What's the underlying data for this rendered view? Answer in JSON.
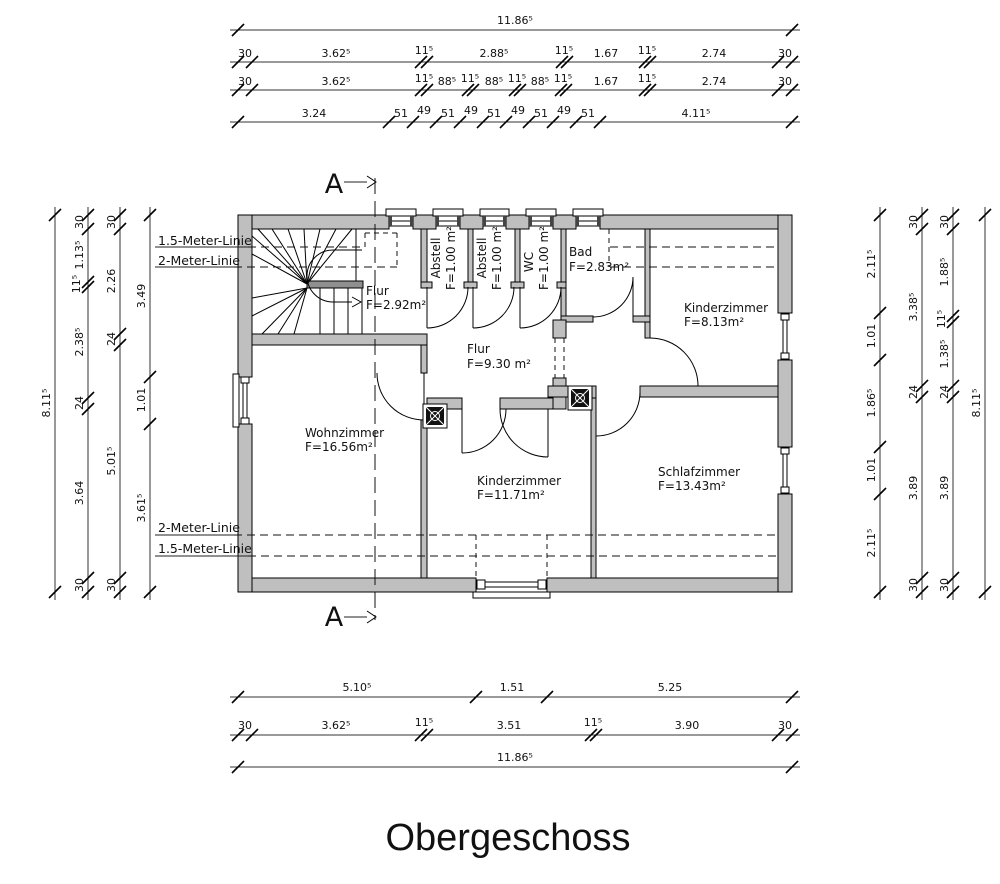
{
  "title": "Obergeschoss",
  "section": {
    "letter": "A"
  },
  "rooms": {
    "stair_flur": {
      "name": "Flur",
      "area": "F=2.92m²"
    },
    "abstell1": {
      "name": "Abstell",
      "area": "F=1.00 m²"
    },
    "abstell2": {
      "name": "Abstell",
      "area": "F=1.00 m²"
    },
    "wc": {
      "name": "WC",
      "area": "F=1.00 m²"
    },
    "bad": {
      "name": "Bad",
      "area": "F=2.83m²"
    },
    "kinderzimmer_top": {
      "name": "Kinderzimmer",
      "area": "F=8.13m²"
    },
    "flur": {
      "name": "Flur",
      "area": "F=9.30 m²"
    },
    "wohnzimmer": {
      "name": "Wohnzimmer",
      "area": "F=16.56m²"
    },
    "kinderzimmer_bottom": {
      "name": "Kinderzimmer",
      "area": "F=11.71m²"
    },
    "schlafzimmer": {
      "name": "Schlafzimmer",
      "area": "F=13.43m²"
    }
  },
  "guide_labels": {
    "top_15": "1.5-Meter-Linie",
    "top_20": "2-Meter-Linie",
    "bottom_20": "2-Meter-Linie",
    "bottom_15": "1.5-Meter-Linie"
  },
  "dims": {
    "top": {
      "total": "11.86⁵",
      "row2": [
        "30",
        "3.62⁵",
        "11⁵",
        "2.88⁵",
        "11⁵",
        "1.67",
        "11⁵",
        "2.74",
        "30"
      ],
      "row3": [
        "30",
        "3.62⁵",
        "11⁵",
        "88⁵",
        "11⁵",
        "88⁵",
        "11⁵",
        "88⁵",
        "11⁵",
        "1.67",
        "11⁵",
        "2.74",
        "30"
      ],
      "row4": [
        "3.24",
        "51",
        "49",
        "51",
        "49",
        "51",
        "49",
        "51",
        "49",
        "51",
        "4.11⁵"
      ]
    },
    "bottom": {
      "row1": [
        "5.10⁵",
        "1.51",
        "5.25"
      ],
      "row2": [
        "30",
        "3.62⁵",
        "11⁵",
        "3.51",
        "11⁵",
        "3.90",
        "30"
      ],
      "total": "11.86⁵"
    },
    "left": {
      "total": "8.11⁵",
      "col2": [
        "30",
        "1.13⁵",
        "11⁵",
        "2.38⁵",
        "24",
        "3.64",
        "30"
      ],
      "col3": [
        "30",
        "2.26",
        "24",
        "5.01⁵",
        "30"
      ],
      "col4": [
        "3.49",
        "1.01",
        "3.61⁵"
      ]
    },
    "right": {
      "col1": [
        "2.11⁵",
        "1.01",
        "1.86⁵",
        "1.01",
        "2.11⁵"
      ],
      "col2": [
        "30",
        "3.38⁵",
        "24",
        "3.89",
        "30"
      ],
      "col3": [
        "30",
        "1.88⁵",
        "11⁵",
        "1.38⁵",
        "24",
        "3.89",
        "30"
      ],
      "total": "8.11⁵"
    }
  }
}
